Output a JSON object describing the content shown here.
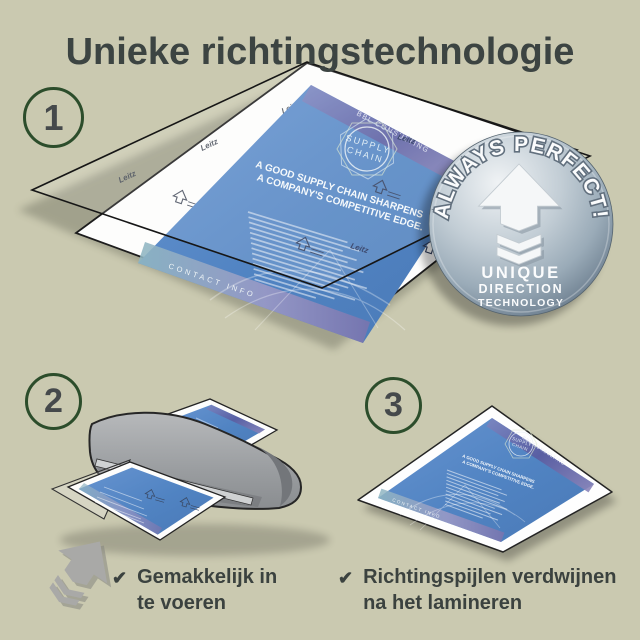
{
  "page": {
    "title": "Unieke richtingstechnologie",
    "background_color": "#cac9b0",
    "title_color": "#3c4442"
  },
  "steps": [
    {
      "number": "1"
    },
    {
      "number": "2"
    },
    {
      "number": "3"
    }
  ],
  "badge": {
    "arc_text": "ALWAYS PERFECT!",
    "lines": [
      "UNIQUE",
      "DIRECTION",
      "TECHNOLOGY"
    ],
    "icon": "up-arrow-with-chevrons",
    "colors": {
      "light": "#f0f3f5",
      "mid": "#9aabb8",
      "dark": "#5a6c7e"
    }
  },
  "document": {
    "watermark": "Leitz",
    "logo": {
      "line1": "SUPPLY",
      "line2": "CHAIN"
    },
    "heading_line1": "A GOOD SUPPLY CHAIN SHARPENS",
    "heading_line2": "A COMPANY'S COMPETITIVE EDGE.",
    "top_band": "BBL CONSULTING",
    "bottom_band": "CONTACT INFO"
  },
  "checklist": {
    "items": [
      {
        "label": "Gemakkelijk in te voeren"
      },
      {
        "label": "Richtingspijlen verdwijnen na het lamineren"
      }
    ]
  },
  "icons": {
    "check": "✔",
    "direction_arrow": "up-arrow-with-chevrons"
  },
  "colors": {
    "accent_green": "#2c4d2b",
    "doc_blue": "#5083c2",
    "band_purple": "#5a5a9f",
    "band_teal": "#83b0bf",
    "machine_gray": "#9a9da0",
    "outline_black": "#1d1d1d"
  }
}
